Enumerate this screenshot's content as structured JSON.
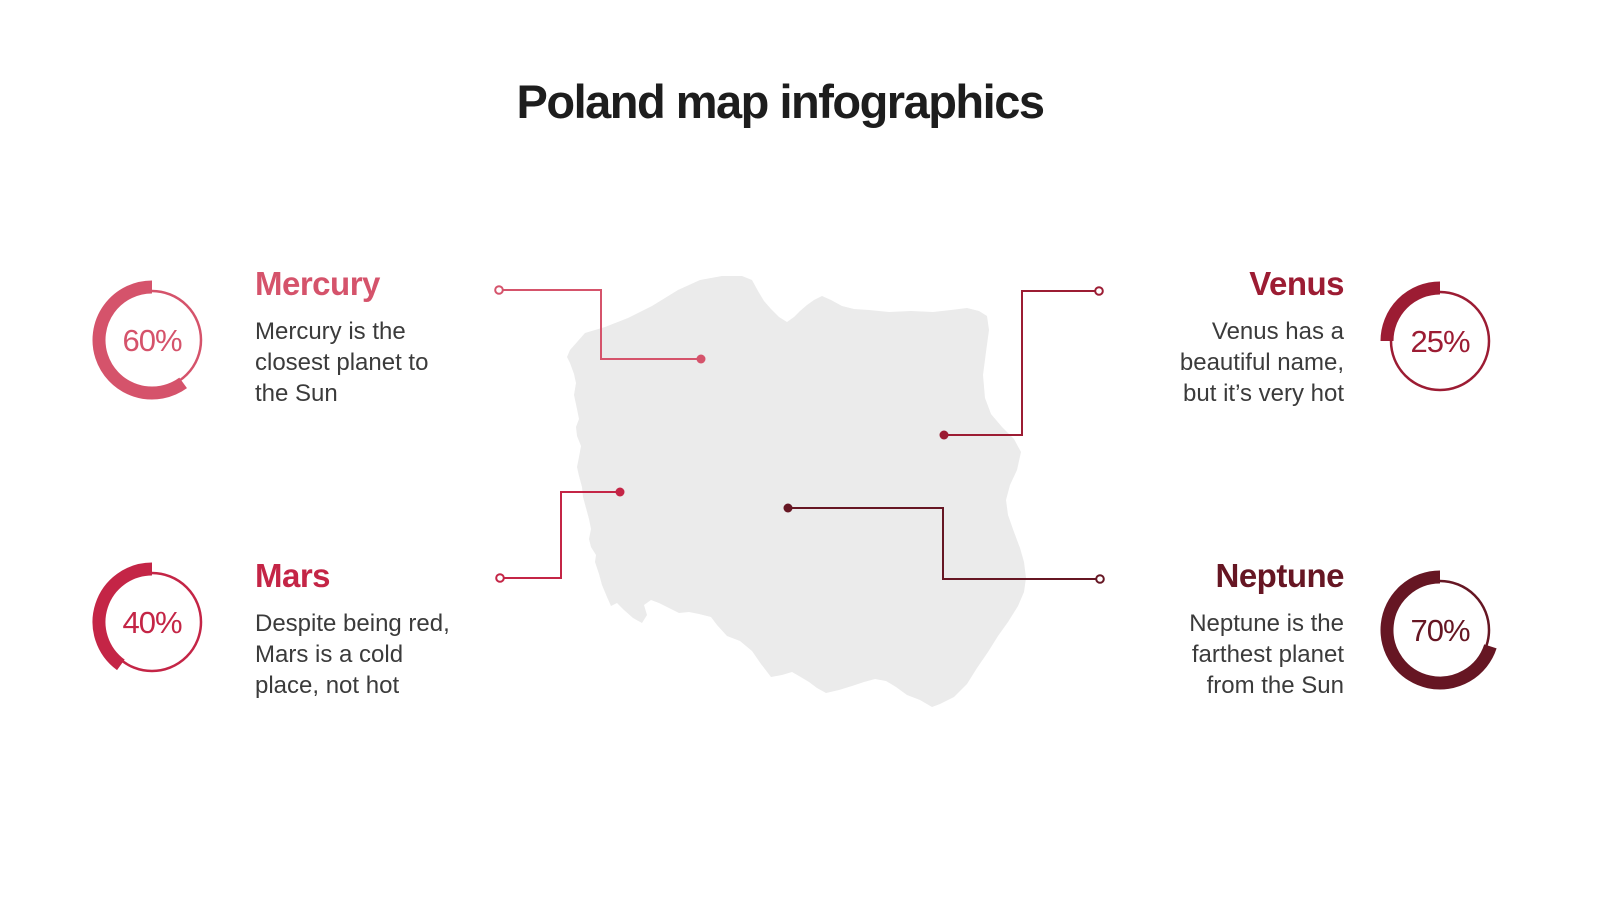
{
  "title": "Poland map infographics",
  "colors": {
    "title_text": "#1d1d1d",
    "body_text": "#3b3b3b",
    "map_fill": "#ebebeb",
    "mercury": "#d5536b",
    "venus": "#9c1c33",
    "mars": "#c42546",
    "neptune": "#661623"
  },
  "planets": [
    {
      "id": "mercury",
      "name": "Mercury",
      "percent": 60,
      "percent_label": "60%",
      "description": "Mercury is the\nclosest planet to\nthe Sun",
      "color": "#d5536b",
      "side": "left"
    },
    {
      "id": "venus",
      "name": "Venus",
      "percent": 25,
      "percent_label": "25%",
      "description": "Venus has a\nbeautiful name,\nbut it’s very hot",
      "color": "#9c1c33",
      "side": "right"
    },
    {
      "id": "mars",
      "name": "Mars",
      "percent": 40,
      "percent_label": "40%",
      "description": "Despite being red,\nMars is a cold\nplace, not hot",
      "color": "#c42546",
      "side": "left"
    },
    {
      "id": "neptune",
      "name": "Neptune",
      "percent": 70,
      "percent_label": "70%",
      "description": "Neptune is the\nfarthest planet\nfrom the Sun",
      "color": "#661623",
      "side": "right"
    }
  ],
  "chart_data": {
    "type": "pie",
    "subtype": "donut-gauge",
    "series": [
      {
        "name": "Mercury",
        "value": 60,
        "label": "60%",
        "color": "#d5536b"
      },
      {
        "name": "Venus",
        "value": 25,
        "label": "25%",
        "color": "#9c1c33"
      },
      {
        "name": "Mars",
        "value": 40,
        "label": "40%",
        "color": "#c42546"
      },
      {
        "name": "Neptune",
        "value": 70,
        "label": "70%",
        "color": "#661623"
      }
    ],
    "title": "Poland map infographics",
    "legend_position": "none",
    "notes": "Four donut gauges linked by connector lines to points on a light gray Poland map silhouette"
  }
}
